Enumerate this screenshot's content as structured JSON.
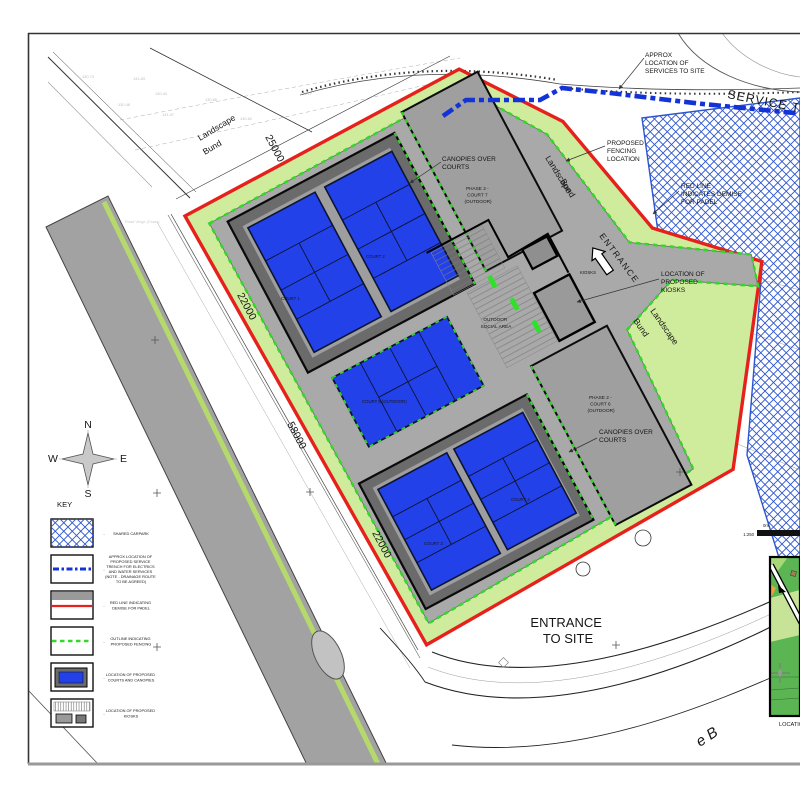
{
  "colors": {
    "red_line": "#e6211c",
    "fence_green": "#35d72c",
    "landscape_green": "#cfec9d",
    "court_blue": "#2341e8",
    "carpark_hatch_blue": "#2c55cf",
    "trench_blue": "#1433d6",
    "plateau_grey": "#a9a9a9"
  },
  "plan_labels": {
    "landscape_bund_nw": [
      "Landscape",
      "Bund"
    ],
    "landscape_bund_ne": [
      "Landscape",
      "Bund"
    ],
    "landscape_bund_e": [
      "Landscape",
      "Bund"
    ],
    "approx_services": [
      "APPROX",
      "LOCATION OF",
      "SERVICES TO SITE"
    ],
    "service_trench": "SERVICE TRENCH",
    "proposed_fencing": [
      "PROPOSED",
      "FENCING",
      "LOCATION"
    ],
    "red_line_demise": [
      "RED LINE",
      "INDICATES DEMISE",
      "FOR PADEL"
    ],
    "canopies_top": [
      "CANOPIES OVER",
      "COURTS"
    ],
    "canopies_bottom": [
      "CANOPIES OVER",
      "COURTS"
    ],
    "kiosks_location": [
      "LOCATION OF",
      "PROPOSED",
      "KIOSKS"
    ],
    "kiosks": "KIOSKS",
    "entrance": "ENTRANCE",
    "entrance_to_site": [
      "ENTRANCE",
      "TO SITE"
    ],
    "outdoor_social": [
      "OUTDOOR",
      "SOCIAL AREA"
    ],
    "phase2_court7": [
      "PHASE 2 -",
      "COURT 7",
      "(OUTDOOR)"
    ],
    "phase2_court6": [
      "PHASE 2 -",
      "COURT 6",
      "(OUTDOOR)"
    ],
    "court1": "COURT 1",
    "court2": "COURT 2",
    "court3": "COURT 3",
    "court4": "COURT 4",
    "court5": "COURT 5 (OUTDOOR)",
    "road_name_fragment": "e B",
    "road_verge": "Road Verge (Grass)"
  },
  "dimensions": {
    "nw": "25000",
    "sw_upper": "22000",
    "sw_mid": "58000",
    "sw_lower": "22000"
  },
  "compass": {
    "n": "N",
    "s": "S",
    "e": "E",
    "w": "W"
  },
  "key": {
    "title": "KEY",
    "separator": "-",
    "items": [
      {
        "label": [
          "SHARED CARPARK"
        ]
      },
      {
        "label": [
          "APPROX LOCATION OF",
          "PROPOSED SERVICE",
          "TRENCH FOR ELECTRICS",
          "AND WATER SERVICES",
          "(NOTE - DRAINAGE ROUTE",
          "TO BE AGREED)"
        ]
      },
      {
        "label": [
          "RED LINE INDICATING",
          "DEMISE FOR PADEL"
        ]
      },
      {
        "label": [
          "OUTLINE INDICATING",
          "PROPOSED FENCING"
        ]
      },
      {
        "label": [
          "LOCATION OF PROPOSED",
          "COURTS AND CANOPIES"
        ]
      },
      {
        "label": [
          "LOCATION OF PROPOSED",
          "KIOSKS"
        ]
      }
    ]
  },
  "scale_bar": {
    "zero": "0m",
    "ratio": "1:250"
  },
  "inset": {
    "caption": "LOCATION"
  },
  "spot_levels": [
    "130.73",
    "131.83",
    "130.48",
    "130.44",
    "131.47",
    "130.88",
    "130.82",
    "131.17"
  ]
}
